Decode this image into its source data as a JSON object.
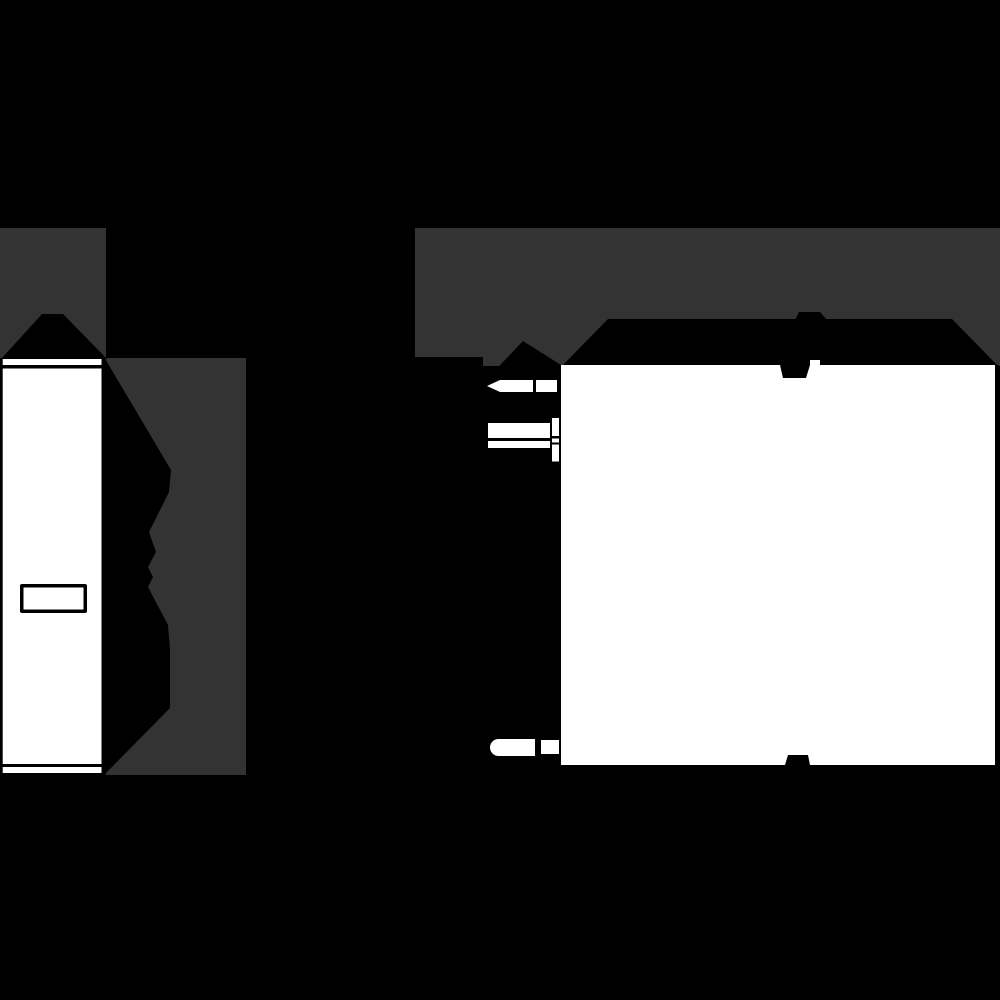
{
  "colors": {
    "background": "#000000",
    "shadow": "#333333",
    "ink": "#000000",
    "paper": "#ffffff"
  },
  "figure": {
    "type": "technical-drawing",
    "views": [
      {
        "id": "side-view",
        "parts": [
          "shadow-backdrop-top",
          "shadow-backdrop-right",
          "roof",
          "housing-side-profile",
          "front-face",
          "top-cap-strip",
          "bottom-cap-strip",
          "label-window"
        ]
      },
      {
        "id": "front-view",
        "parts": [
          "shadow-backdrop",
          "top-band",
          "din-clip-top-bump",
          "din-clip-top-tab",
          "terminal-column",
          "terminal-pin-top",
          "screw-terminal",
          "terminal-pin-bottom",
          "body-face",
          "din-clip-bottom-bump",
          "din-clip-bottom-tab"
        ]
      }
    ]
  }
}
